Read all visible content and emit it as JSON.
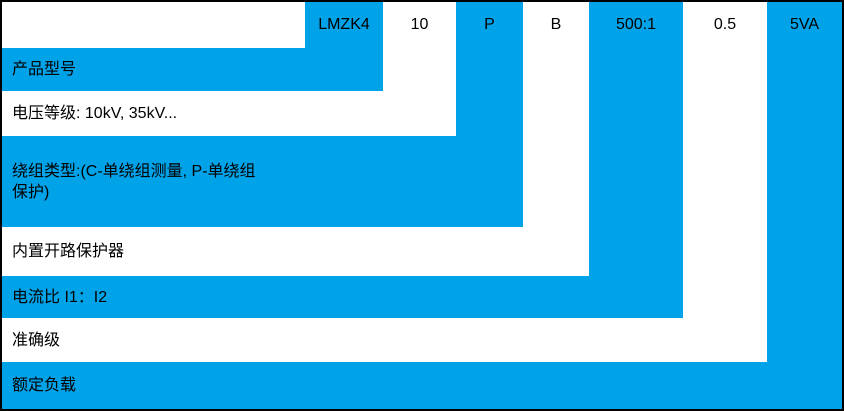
{
  "code": {
    "segments": [
      "LMZK4",
      "10",
      "P",
      "B",
      "500:1",
      "0.5",
      "5VA"
    ]
  },
  "rows": [
    {
      "label": "产品型号",
      "highlighted": true
    },
    {
      "label": "电压等级: 10kV, 35kV...",
      "highlighted": false
    },
    {
      "label": "绕组类型:(C-单绕组测量, P-单绕组\n保护)",
      "highlighted": true
    },
    {
      "label": "内置开路保护器",
      "highlighted": false
    },
    {
      "label": "电流比 I1：I2",
      "highlighted": true
    },
    {
      "label": "准确级",
      "highlighted": false
    },
    {
      "label": "额定负载",
      "highlighted": true
    }
  ],
  "colors": {
    "highlight": "#00A2E8",
    "background": "#FFFFFF",
    "border": "#000000",
    "text": "#000000"
  }
}
